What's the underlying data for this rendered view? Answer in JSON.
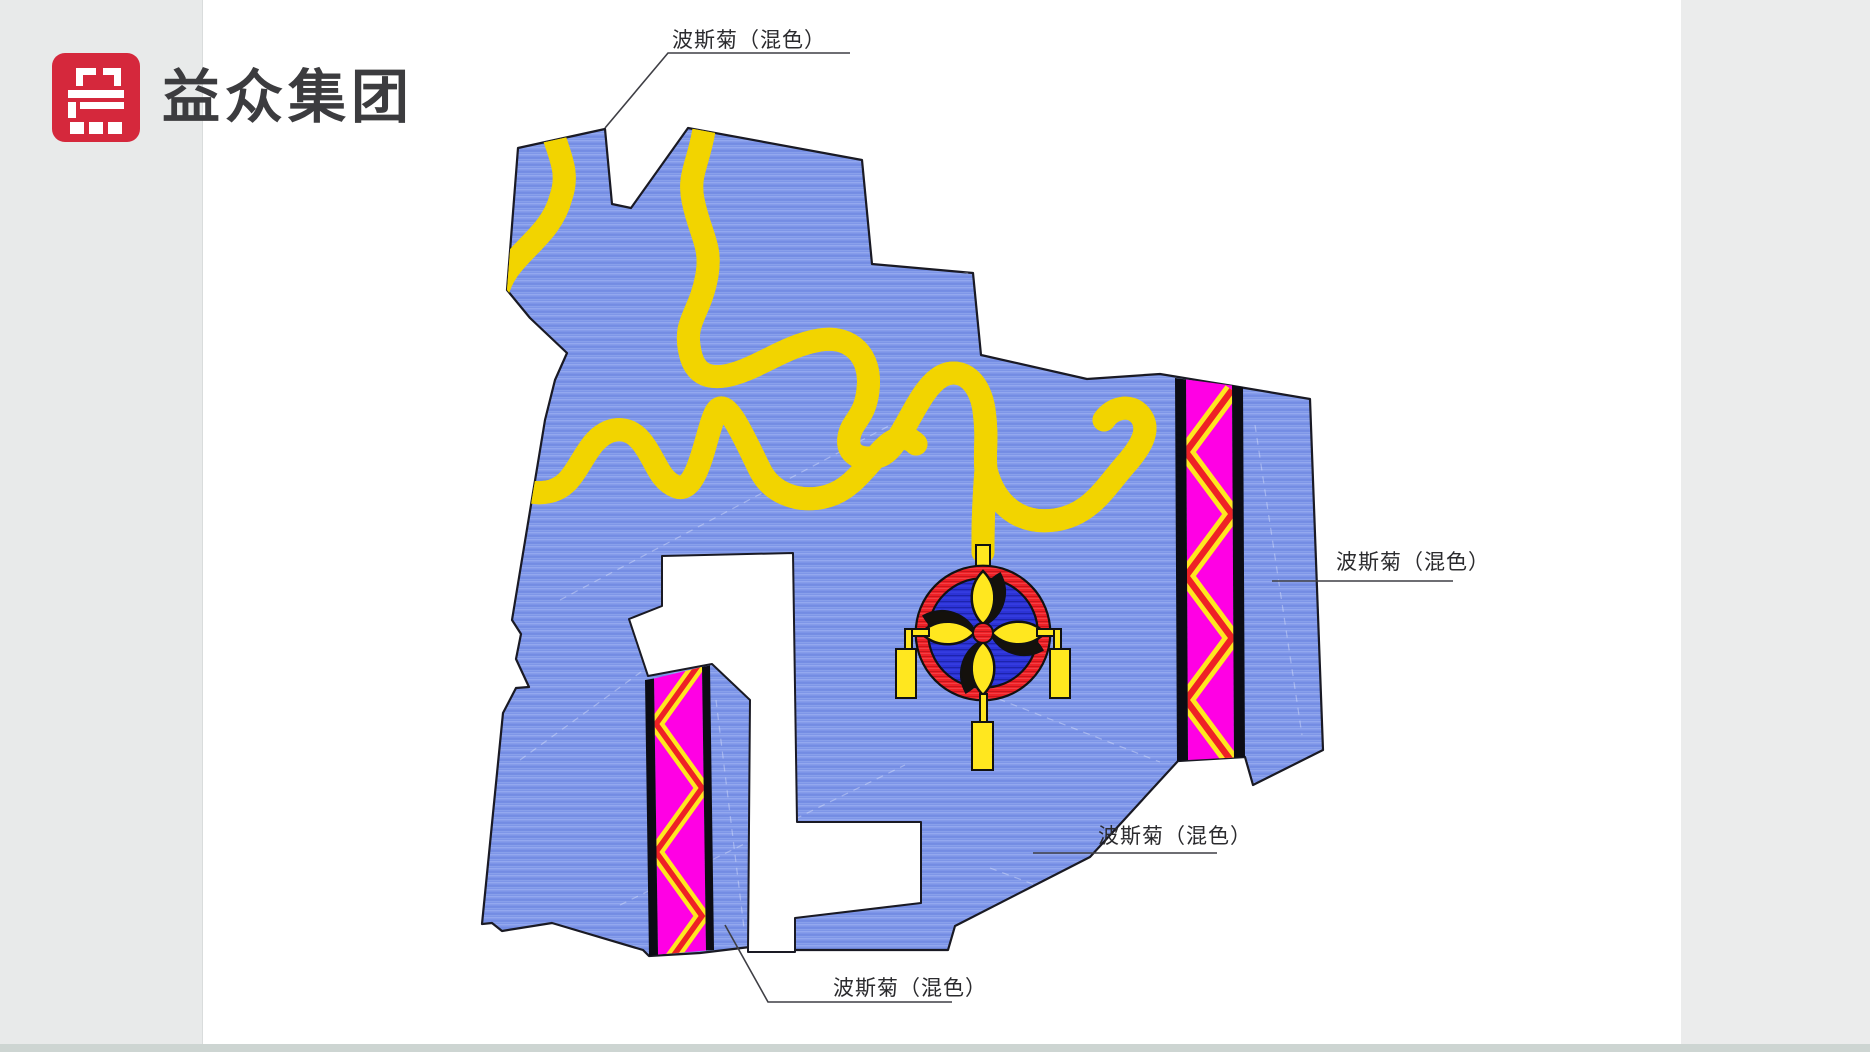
{
  "window": {
    "background_color": "#e8eaea",
    "page_background": "#ffffff",
    "bottom_bar_color": "#cdd5d2"
  },
  "logo": {
    "company_name": "益众集团",
    "mark_color": "#d5283c",
    "text_color": "#3c3c3f"
  },
  "diagram": {
    "plant_name": "波斯菊",
    "labels": {
      "top": "波斯菊（混色）",
      "right": "波斯菊（混色）",
      "middle": "波斯菊（混色）",
      "bottom": "波斯菊（混色）"
    },
    "colors": {
      "field_blue": "#7d95e8",
      "field_blue_light": "#93a8ef",
      "field_blue_dark": "#6d86e0",
      "medallion_blue": "#2c33d6",
      "ribbon_red": "#ee2127",
      "ribbon_edge_yellow": "#f2d400",
      "band_magenta": "#ff00e4",
      "band_yellow": "#ffe71f",
      "band_red": "#ee2126",
      "outline_black": "#1a1a24",
      "leader_line": "#3f3f45"
    }
  }
}
